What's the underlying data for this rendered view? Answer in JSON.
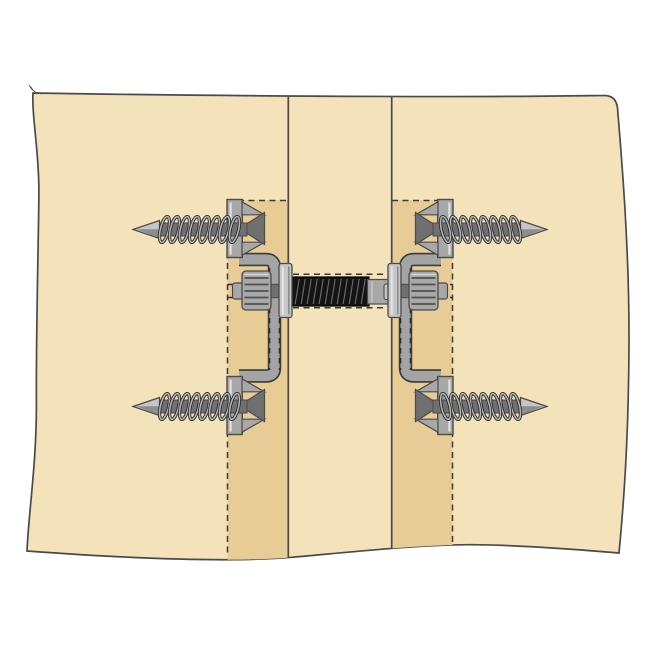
{
  "figure": {
    "kind": "technical-illustration",
    "components": [
      "wood-panel",
      "page-curl",
      "center-board",
      "left-batten",
      "right-batten",
      "connector-arm-left",
      "connector-arm-right",
      "threaded-rod",
      "tension-spring",
      "threaded-sleeve",
      "hex-nut-left",
      "hex-nut-right",
      "washer-plate-left",
      "washer-plate-right",
      "bracket-plate",
      "countersink-funnel",
      "lag-screw-top-left",
      "lag-screw-top-right",
      "lag-screw-bottom-left",
      "lag-screw-bottom-right"
    ]
  },
  "colors": {
    "background": "#ffffff",
    "wood_panel": "#f3e2ba",
    "wood_batten": "#e8cc95",
    "outline": "#4a4a4a",
    "metal_light": "#c6c6c6",
    "metal_mid": "#a8a8a8",
    "metal_dark": "#707070",
    "coil_stroke": "#2b2b2b",
    "tension_spring": "#141414"
  }
}
